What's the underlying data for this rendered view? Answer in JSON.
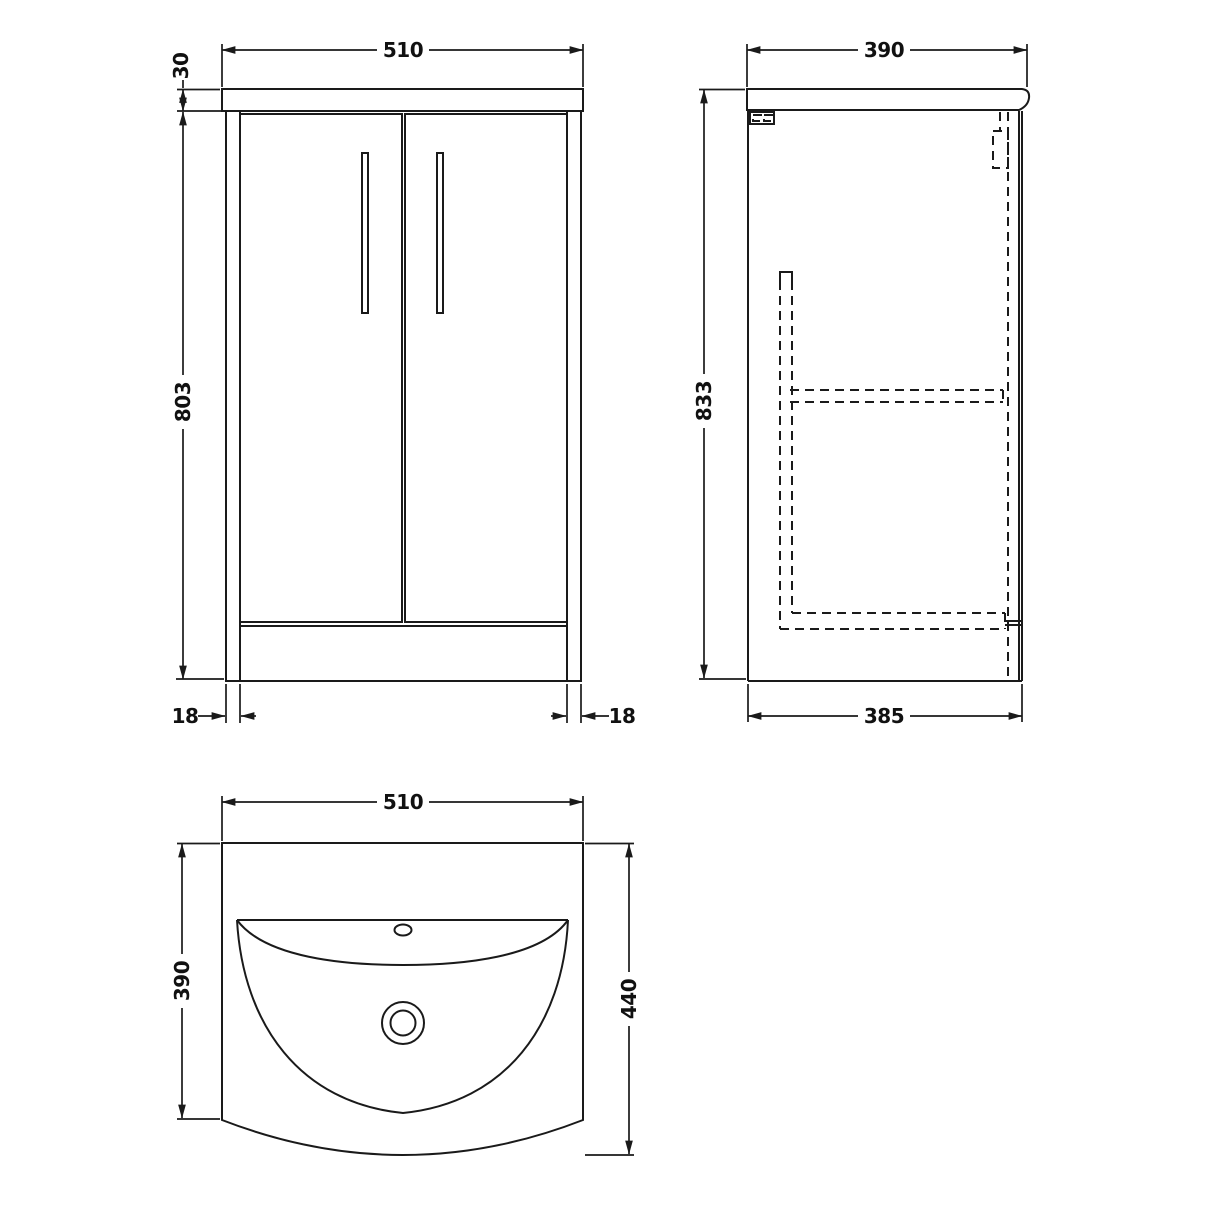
{
  "drawing_type": "vanity-unit-technical-drawing",
  "views": {
    "front": {
      "dims": {
        "width": "510",
        "worktop_thickness": "30",
        "cabinet_height": "803",
        "left_panel_thickness": "18",
        "right_panel_thickness": "18"
      }
    },
    "side": {
      "dims": {
        "worktop_depth": "390",
        "overall_height": "833",
        "cabinet_depth": "385"
      }
    },
    "plan": {
      "dims": {
        "width": "510",
        "basin_depth": "390",
        "overall_depth": "440"
      }
    }
  },
  "colors": {
    "line": "#1a1a1a",
    "background": "#ffffff"
  }
}
